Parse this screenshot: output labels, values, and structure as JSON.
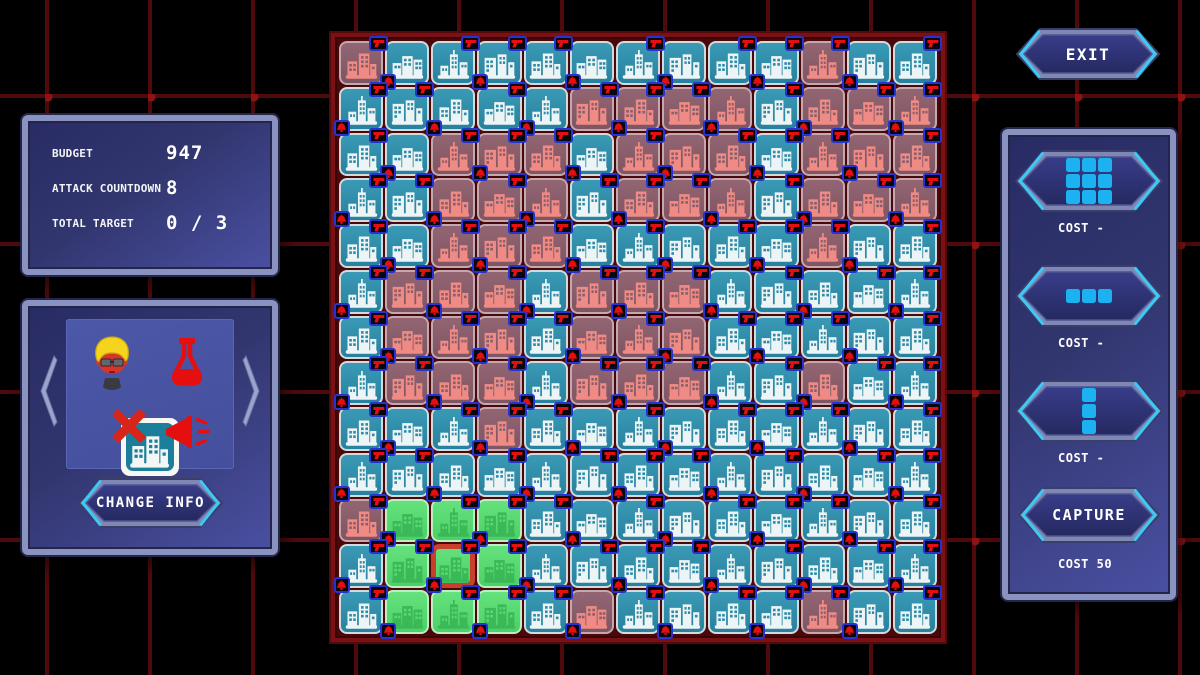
{
  "colors": {
    "background_grid_line": "#4f0a0b",
    "background_tick": "#8e1414",
    "panel_border": "#8a92c0",
    "panel_fill_dark": "#282b64",
    "panel_fill_light": "#4a50a2",
    "accent_cyan": "#3cc9f6",
    "shape_square_cyan": "#1cb2f2",
    "tile_teal": "#2d8ba7",
    "tile_mauve": "#8a5e6b",
    "tile_green": "#58da72",
    "selected_outline": "#c8402c",
    "badge_red": "#e60f0f",
    "badge_border_blue": "#2633d2",
    "board_frame_red": "#7c1115"
  },
  "stats_panel": {
    "rows": [
      {
        "label": "BUDGET",
        "value": "947"
      },
      {
        "label": "ATTACK COUNTDOWN",
        "value": "8"
      },
      {
        "label": "TOTAL TARGET",
        "value": "0 / 3"
      }
    ]
  },
  "character_panel": {
    "icons": [
      "avatar-icon",
      "flask-icon",
      "no-building-icon",
      "megaphone-icon"
    ],
    "change_info_label": "CHANGE INFO"
  },
  "exit_button": {
    "label": "EXIT"
  },
  "shop_panel": {
    "items": [
      {
        "name": "block-3x3",
        "shape": [
          [
            1,
            1,
            1
          ],
          [
            1,
            1,
            1
          ],
          [
            1,
            1,
            1
          ]
        ],
        "cost": "COST -"
      },
      {
        "name": "row-1x3",
        "shape": [
          [
            1,
            1,
            1
          ]
        ],
        "cost": "COST -"
      },
      {
        "name": "column-3x1",
        "shape": [
          [
            1
          ],
          [
            1
          ],
          [
            1
          ]
        ],
        "cost": "COST -"
      }
    ],
    "capture": {
      "label": "CAPTURE",
      "cost": "COST 50"
    }
  },
  "board": {
    "rows": 13,
    "cols": 13,
    "selected_cell": {
      "row": 11,
      "col": 2
    },
    "cell_legend": {
      "T": "teal-city-tile",
      "M": "mauve-enemy-tile",
      "G": "green-captured-tile",
      "S": "selected-green-tile",
      "g": "gun-badge",
      "b": "bell-badge",
      "x": "gun-and-bell-badges",
      "digit": "building-variant"
    },
    "cells": [
      "Mg0 Tb1 Tg2 Tx3 Tg0 Tb1 Tg2 Tb3 Tg0 Tx1 Mg2 Tb3 Tg0",
      "Tx2 Tg3 Tb0 Tg1 Tb2 Mg3 Mx0 Mg1 Mb2 Tg3 Mb0 Mg1 Mx2",
      "Tg0 Tb1 Mg2 Mx3 Mg0 Tb1 Mg2 Mb3 Mg0 Tx1 Mg2 Mb3 Mg0",
      "Tx2 Tg3 Mb0 Mg1 Mb2 Tg3 Mx0 Mg1 Mb2 Tg3 Mb0 Mg1 Mx2",
      "Tg0 Tb1 Mg2 Mx3 Mg0 Tb1 Tg2 Tb3 Tg0 Tx1 Mg2 Tb3 Tg0",
      "Tx2 Mg3 Mb0 Mg1 Tb2 Mg3 Mx0 Mg1 Tb2 Tg3 Tb0 Tg1 Tx2",
      "Tg0 Mb1 Mg2 Mx3 Tg0 Mb1 Mg2 Mb3 Tg0 Tx1 Tg2 Tb3 Tg0",
      "Tx2 Mg3 Mb0 Mg1 Tb2 Mg3 Mx0 Mg1 Tb2 Tg3 Mb0 Tg1 Tx2",
      "Tg0 Tb1 Tg2 Mx3 Tg0 Tb1 Tg2 Tb3 Tg0 Tx1 Tg2 Tb3 Tg0",
      "Tx2 Tg3 Tb0 Tg1 Tb2 Tg3 Tx0 Tg1 Tb2 Tg3 Tb0 Tg1 Tx2",
      "Mg0 Gb1 Gg2 Gx3 Tg0 Tb1 Tg2 Tb3 Tg0 Tx1 Tg2 Tb3 Tg0",
      "Tx2 Gg3 Sx0 Gg1 Tb2 Tg3 Tx0 Tg1 Tb2 Tg3 Tb0 Tg1 Tx2",
      "Tg0 Gb1 Gg2 Gx3 Tg0 Mb1 Tg2 Tb3 Tg0 Tx1 Mg2 Tb3 Tg0"
    ]
  }
}
